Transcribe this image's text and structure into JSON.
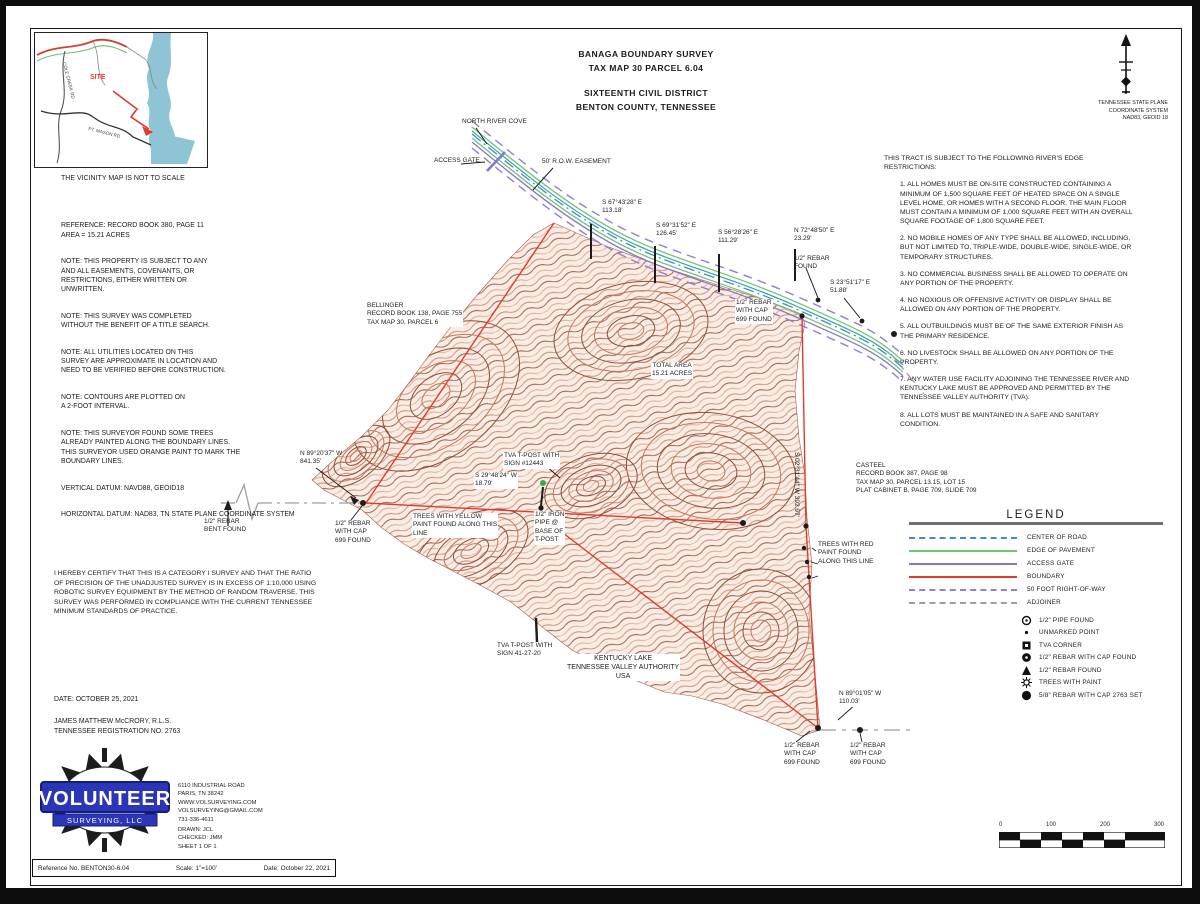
{
  "title_block": {
    "line1": "BANAGA BOUNDARY SURVEY",
    "line2": "TAX MAP 30 PARCEL 6.04",
    "line3": "SIXTEENTH CIVIL DISTRICT",
    "line4": "BENTON COUNTY, TENNESSEE"
  },
  "vicinity": {
    "note": "THE VICINITY MAP IS NOT TO SCALE",
    "site": "SITE",
    "road1": "PT. MASON RD",
    "road2": "COLE CREEK RD"
  },
  "north_block": {
    "line1": "TENNESSEE STATE PLANE",
    "line2": "COORDINATE SYSTEM",
    "line3": "NAD83, GEOID 18"
  },
  "left_notes": {
    "p1": "REFERENCE: RECORD BOOK 380, PAGE 11\nAREA = 15.21 ACRES",
    "p2": "NOTE: THIS PROPERTY IS SUBJECT TO ANY\nAND ALL EASEMENTS, COVENANTS, OR\nRESTRICTIONS, EITHER WRITTEN OR\nUNWRITTEN.",
    "p3": "NOTE: THIS SURVEY WAS COMPLETED\nWITHOUT THE BENEFIT OF A TITLE SEARCH.",
    "p4": "NOTE: ALL UTILITIES LOCATED ON THIS\nSURVEY ARE APPROXIMATE IN LOCATION AND\nNEED TO BE VERIFIED BEFORE CONSTRUCTION.",
    "p5": "NOTE: CONTOURS ARE PLOTTED ON\nA 2-FOOT INTERVAL.",
    "p6": "NOTE: THIS SURVEYOR FOUND SOME TREES\nALREADY PAINTED ALONG THE BOUNDARY LINES.\nTHIS SURVEYOR USED ORANGE PAINT TO MARK THE\nBOUNDARY LINES.",
    "p7": "VERTICAL DATUM: NAVD88, GEOID18",
    "p8": "HORIZONTAL DATUM: NAD83, TN STATE PLANE COORDINATE SYSTEM"
  },
  "restrictions": {
    "heading": "THIS TRACT IS SUBJECT TO THE FOLLOWING RIVER'S EDGE RESTRICTIONS:",
    "items": [
      "1. ALL HOMES MUST BE ON-SITE CONSTRUCTED CONTAINING A MINIMUM OF 1,500 SQUARE FEET OF HEATED SPACE ON A SINGLE LEVEL HOME, OR HOMES WITH A SECOND FLOOR. THE MAIN FLOOR MUST CONTAIN A MINIMUM OF 1,000 SQUARE FEET WITH AN OVERALL SQUARE FOOTAGE OF 1,800 SQUARE FEET.",
      "2. NO MOBILE HOMES OF ANY TYPE SHALL BE ALLOWED, INCLUDING, BUT NOT LIMITED TO, TRIPLE-WIDE, DOUBLE-WIDE, SINGLE-WIDE, OR TEMPORARY STRUCTURES.",
      "3. NO COMMERCIAL BUSINESS SHALL BE ALLOWED TO OPERATE ON ANY PORTION OF THE PROPERTY.",
      "4. NO NOXIOUS OR OFFENSIVE ACTIVITY OR DISPLAY SHALL BE ALLOWED ON ANY PORTION OF THE PROPERTY.",
      "5. ALL OUTBUILDINGS MUST BE OF THE SAME EXTERIOR FINISH AS THE PRIMARY RESIDENCE.",
      "6. NO LIVESTOCK SHALL BE ALLOWED ON ANY PORTION OF THE PROPERTY.",
      "7. ANY WATER USE FACILITY ADJOINING THE TENNESSEE RIVER AND KENTUCKY LAKE MUST BE APPROVED AND PERMITTED BY THE TENNESSEE VALLEY AUTHORITY (TVA).",
      "8. ALL LOTS MUST BE MAINTAINED IN A SAFE AND SANITARY CONDITION."
    ]
  },
  "adjoiners": {
    "bellinger": "BELLINGER\nRECORD BOOK 138, PAGE 755\nTAX MAP 30, PARCEL 6",
    "casteel": "CASTEEL\nRECORD BOOK 387, PAGE 98\nTAX MAP 30, PARCEL 13.15, LOT 15\nPLAT CABINET B, PAGE 709, SLIDE 709"
  },
  "map_labels": {
    "north_river_cove": "NORTH RIVER COVE",
    "access_gate": "ACCESS GATE",
    "row_easement": "50' R.O.W. EASEMENT",
    "b1": "S 67°43'28\" E\n113.18'",
    "b2": "S 69°31'52\" E\n126.45'",
    "b3": "S 56°28'26\" E\n111.29'",
    "b4": "N 72°48'50\" E\n23.29'",
    "b5": "S 23°51'17\" E\n51.88'",
    "b6": "N 89°20'37\" W\n841.35'",
    "b7": "S 29°48'24\" W\n18.79'",
    "b8": "N 89°01'05\" W\n110.03'",
    "b9": "S 02°31'44\" W  392.97'",
    "rebar_found": "1/2\" REBAR\nFOUND",
    "rebar_cap_ne": "1/2\" REBAR\nWITH CAP\n699 FOUND",
    "rebar_bent": "1/2\" REBAR\nBENT FOUND",
    "rebar_cap_w": "1/2\" REBAR\nWITH CAP\n699 FOUND",
    "rebar_cap_s1": "1/2\" REBAR\nWITH CAP\n699 FOUND",
    "rebar_cap_s2": "1/2\" REBAR\nWITH CAP\n699 FOUND",
    "total_area": "TOTAL AREA\n15.21 ACRES",
    "yellow_trees": "TREES WITH YELLOW\nPAINT FOUND ALONG THIS\nLINE",
    "red_trees": "TREES WITH RED\nPAINT FOUND\nALONG THIS LINE",
    "tva_tpost_upper": "TVA T-POST WITH\nSIGN #12443",
    "tva_tpost_lower": "TVA T-POST WITH\nSIGN 41-27-20",
    "iron_pipe": "1/2\" IRON\nPIPE @\nBASE OF\nT-POST",
    "kentucky_lake": "KENTUCKY LAKE\nTENNESSEE VALLEY AUTHORITY\nUSA"
  },
  "legend": {
    "title": "LEGEND",
    "lines": [
      {
        "label": "CENTER OF ROAD",
        "color": "#4a86c8"
      },
      {
        "label": "EDGE OF PAVEMENT",
        "color": "#74c476"
      },
      {
        "label": "ACCESS GATE",
        "color": "#8577c9"
      },
      {
        "label": "BOUNDARY",
        "color": "#e23b2e"
      },
      {
        "label": "50 FOOT RIGHT-OF-WAY",
        "color": "#8d80d6"
      },
      {
        "label": "ADJOINER",
        "color": "#9e9e9e"
      }
    ],
    "symbols": [
      {
        "label": "1/2\" PIPE FOUND"
      },
      {
        "label": "UNMARKED POINT"
      },
      {
        "label": "TVA CORNER"
      },
      {
        "label": "1/2\" REBAR WITH CAP FOUND"
      },
      {
        "label": "1/2\" REBAR FOUND"
      },
      {
        "label": "TREES WITH PAINT"
      },
      {
        "label": "5/8\" REBAR WITH CAP 2763 SET"
      }
    ]
  },
  "certification": {
    "text": "I HEREBY CERTIFY THAT THIS IS A CATEGORY I SURVEY AND THAT THE RATIO OF PRECISION OF THE UNADJUSTED SURVEY IS IN EXCESS OF 1:10,000 USING ROBOTIC SURVEY EQUIPMENT BY THE METHOD OF RANDOM TRAVERSE.  THIS SURVEY WAS PERFORMED IN COMPLIANCE WITH THE CURRENT TENNESSEE MINIMUM STANDARDS OF PRACTICE.",
    "date": "DATE: OCTOBER 25, 2021",
    "surveyor": "JAMES MATTHEW McCRORY, R.L.S.",
    "registration": "TENNESSEE REGISTRATION NO. 2763"
  },
  "logo": {
    "name": "VOLUNTEER",
    "sub": "SURVEYING, LLC",
    "address": "6110 INDUSTRIAL ROAD\nPARIS, TN 38242\nWWW.VOLSURVEYING.COM\nVOLSURVEYING@GMAIL.COM\n731-336-4611",
    "credits": "DRAWN: JCL\nCHECKED: JMM\nSHEET 1 OF 1"
  },
  "footer": {
    "reference": "Reference No. BENTON30-6.04",
    "scale": "Scale: 1\"=100'",
    "date": "Date: October 22, 2021"
  },
  "scale_bar": {
    "t0": "0",
    "t1": "100",
    "t2": "200",
    "t3": "300"
  },
  "colors": {
    "boundary": "#e23b2e",
    "center_road": "#4a86c8",
    "edge_of_pavement": "#74c476",
    "access_gate": "#8577c9",
    "right_of_way": "#8d80d6",
    "adjoiner": "#9e9e9e",
    "contour_dark": "#8f4f38",
    "contour_light": "#c4785a",
    "water": "#8ec4d6",
    "logo_blue": "#2a35b8"
  }
}
